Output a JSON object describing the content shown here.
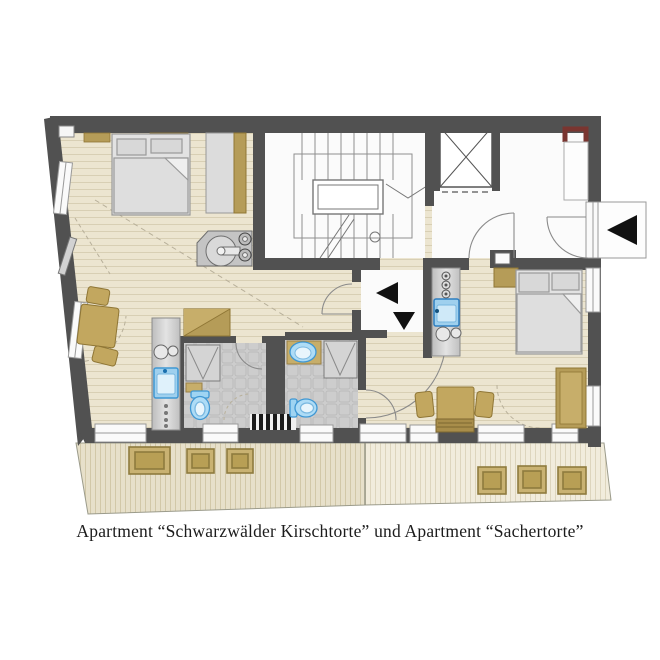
{
  "caption": "Apartment “Schwarzwälder Kirschtorte” und Apartment “Sachertorte”",
  "apartments": [
    {
      "name": "Schwarzwälder Kirschtorte",
      "position": "left"
    },
    {
      "name": "Sachertorte",
      "position": "right"
    }
  ],
  "colors": {
    "wall": "#515151",
    "wood_floor": "#ece5d0",
    "wood_line": "#d8cfb4",
    "deck_left": "#e7e0ca",
    "deck_right": "#f1ecdc",
    "tile": "#cdcdcd",
    "fixture_blue": "#aedcf6",
    "fixture_blue_border": "#3f97d3",
    "furniture_tan": "#c2a75f",
    "furniture_tan_border": "#8f7635",
    "bed_gray": "#e2e2e2",
    "shaft_maroon": "#7a3530",
    "arrow_black": "#111111",
    "room_white": "#fbfbfb"
  },
  "symbols": {
    "rooms": [
      "stairwell",
      "elevator",
      "corridor",
      "entrance-vestibule",
      "bedroom-left",
      "living-left",
      "bathroom-left",
      "bathroom-right",
      "studio-right",
      "balcony-left",
      "balcony-right"
    ],
    "fixtures": [
      "bed",
      "wardrobe",
      "kitchenette",
      "sink",
      "stove-burners",
      "shower",
      "toilet",
      "washbasin",
      "dining-table",
      "chair",
      "bench-sofa",
      "radiator",
      "planter"
    ],
    "markers": [
      "entry-arrow-left",
      "entry-arrow-down",
      "building-entry-arrow",
      "stair-direction-line",
      "elevator-cross"
    ]
  },
  "planters": {
    "left_balcony": 3,
    "right_balcony": 3
  }
}
